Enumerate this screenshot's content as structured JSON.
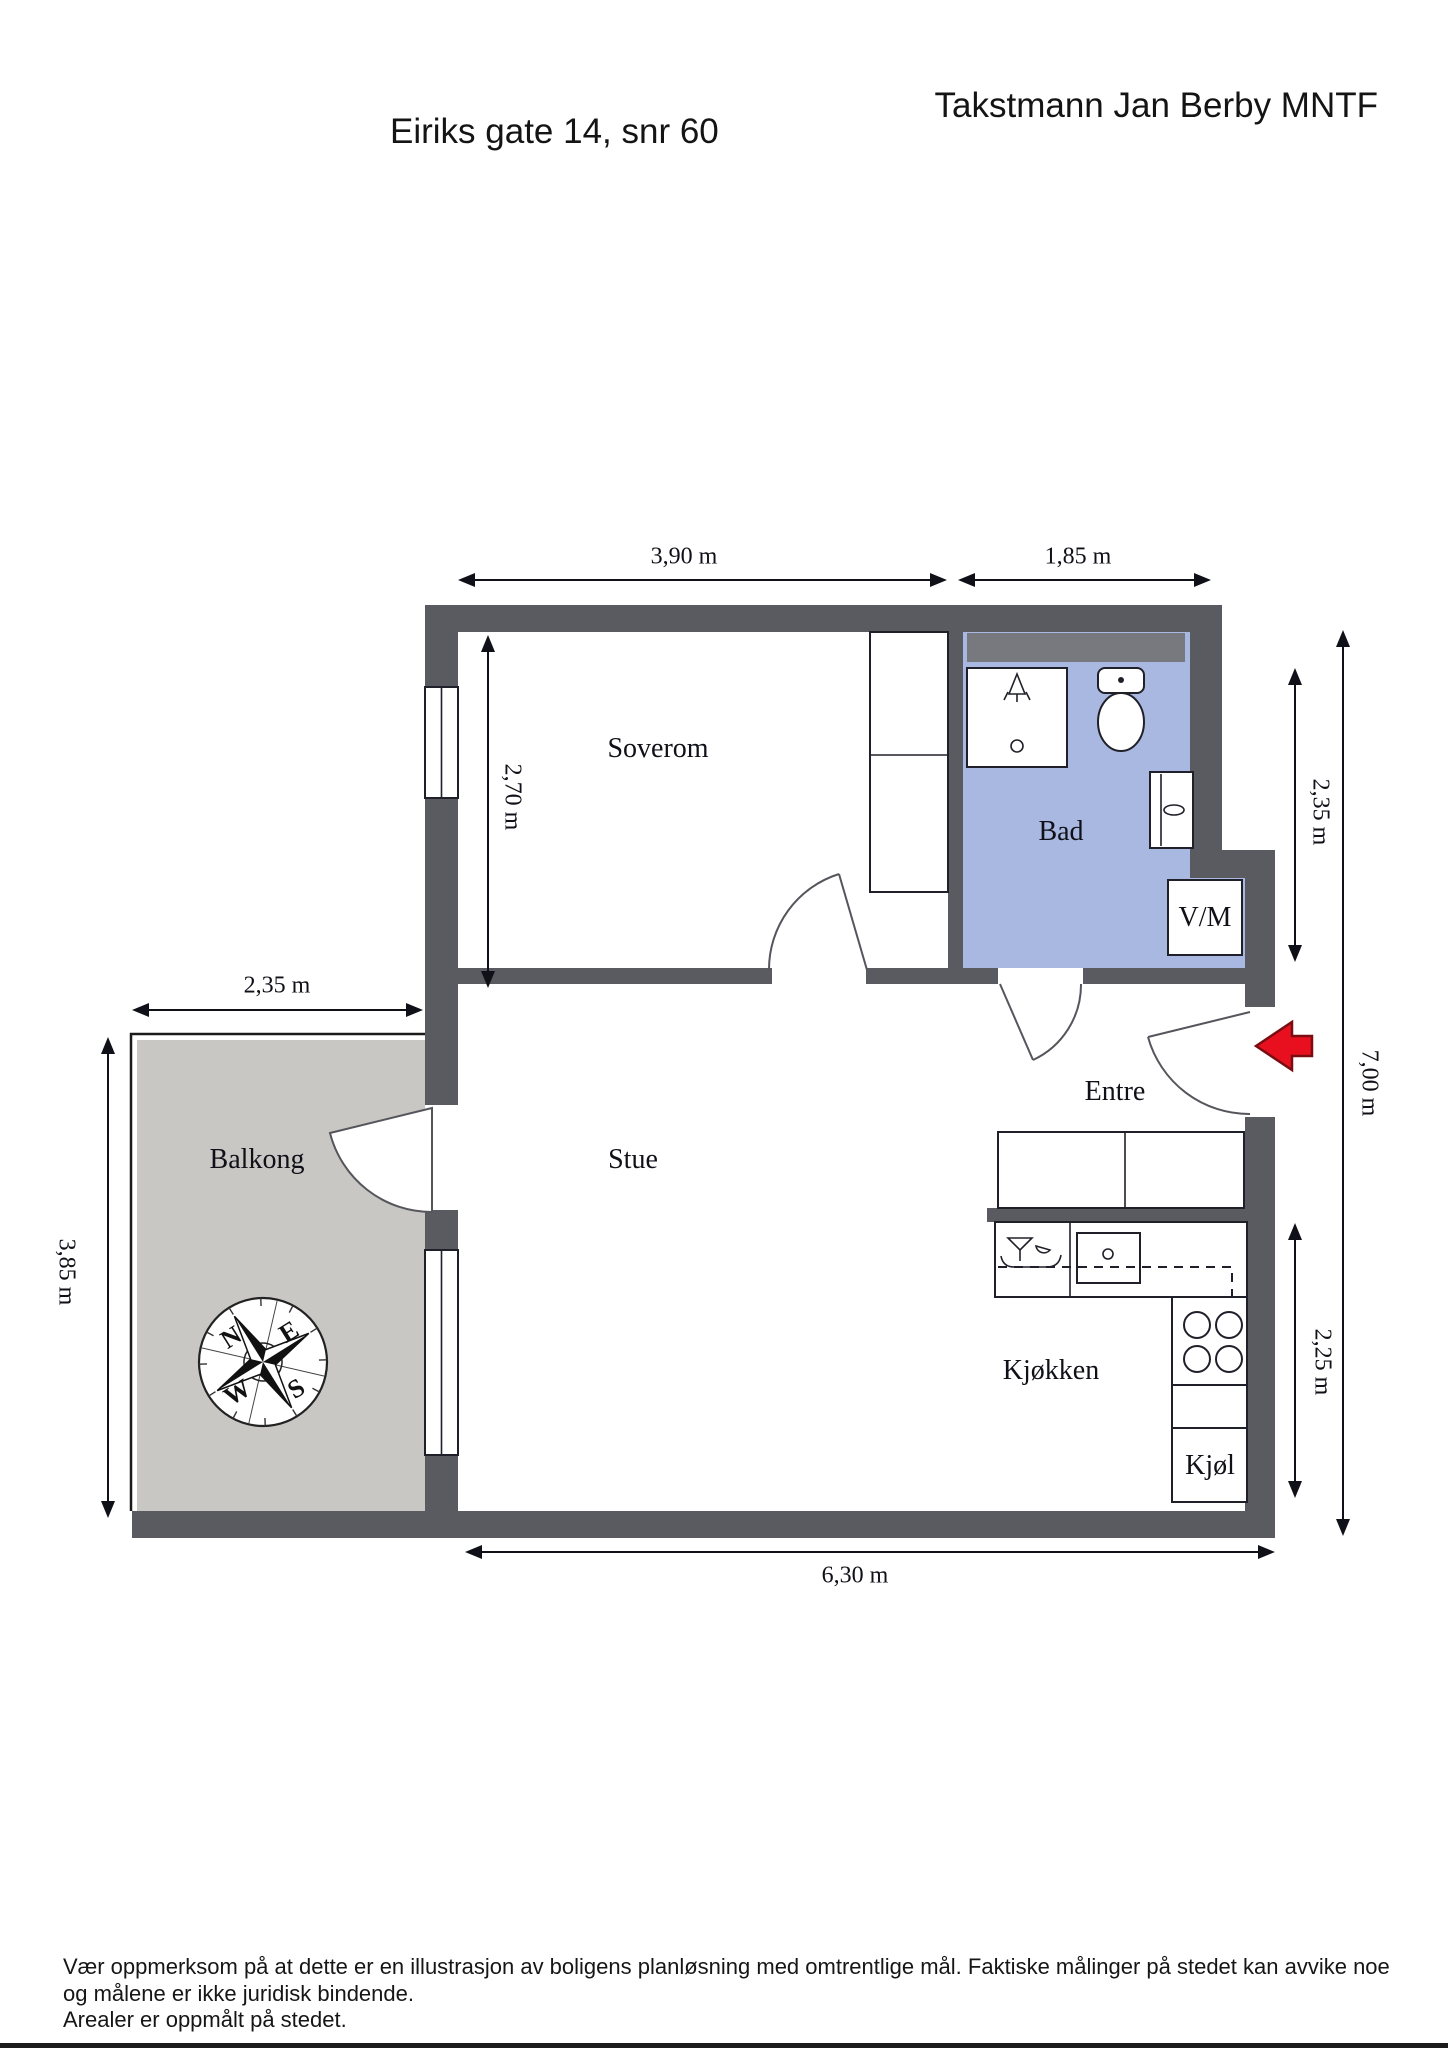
{
  "header": {
    "surveyor": "Takstmann Jan Berby MNTF",
    "address": "Eiriks gate 14, snr 60"
  },
  "rooms": {
    "soverom": "Soverom",
    "bad": "Bad",
    "vm": "V/M",
    "entre": "Entre",
    "stue": "Stue",
    "balkong": "Balkong",
    "kjokken": "Kjøkken",
    "kjol": "Kjøl"
  },
  "dimensions": {
    "bedroom_width": "3,90 m",
    "bath_width": "1,85 m",
    "bedroom_depth": "2,70 m",
    "bath_depth": "2,35 m",
    "right_total": "7,00 m",
    "balcony_width": "2,35 m",
    "balcony_depth": "3,85 m",
    "kitchen_depth": "2,25 m",
    "bottom_width": "6,30 m"
  },
  "compass": {
    "n": "N",
    "e": "E",
    "s": "S",
    "w": "W"
  },
  "footer": {
    "line1": "Vær oppmerksom på at dette er en illustrasjon av boligens planløsning med omtrentlige mål. Faktiske målinger på stedet kan avvike noe",
    "line2": "og målene er ikke juridisk bindende.",
    "line3": "Arealer er oppmålt på stedet."
  },
  "colors": {
    "wall": "#5a5a61",
    "bath_floor": "#a9b8e0",
    "bath_band": "#78787f",
    "balcony_floor": "#c9c7c4",
    "accent_red": "#e8101e",
    "accent_red_border": "#7a0d12"
  }
}
